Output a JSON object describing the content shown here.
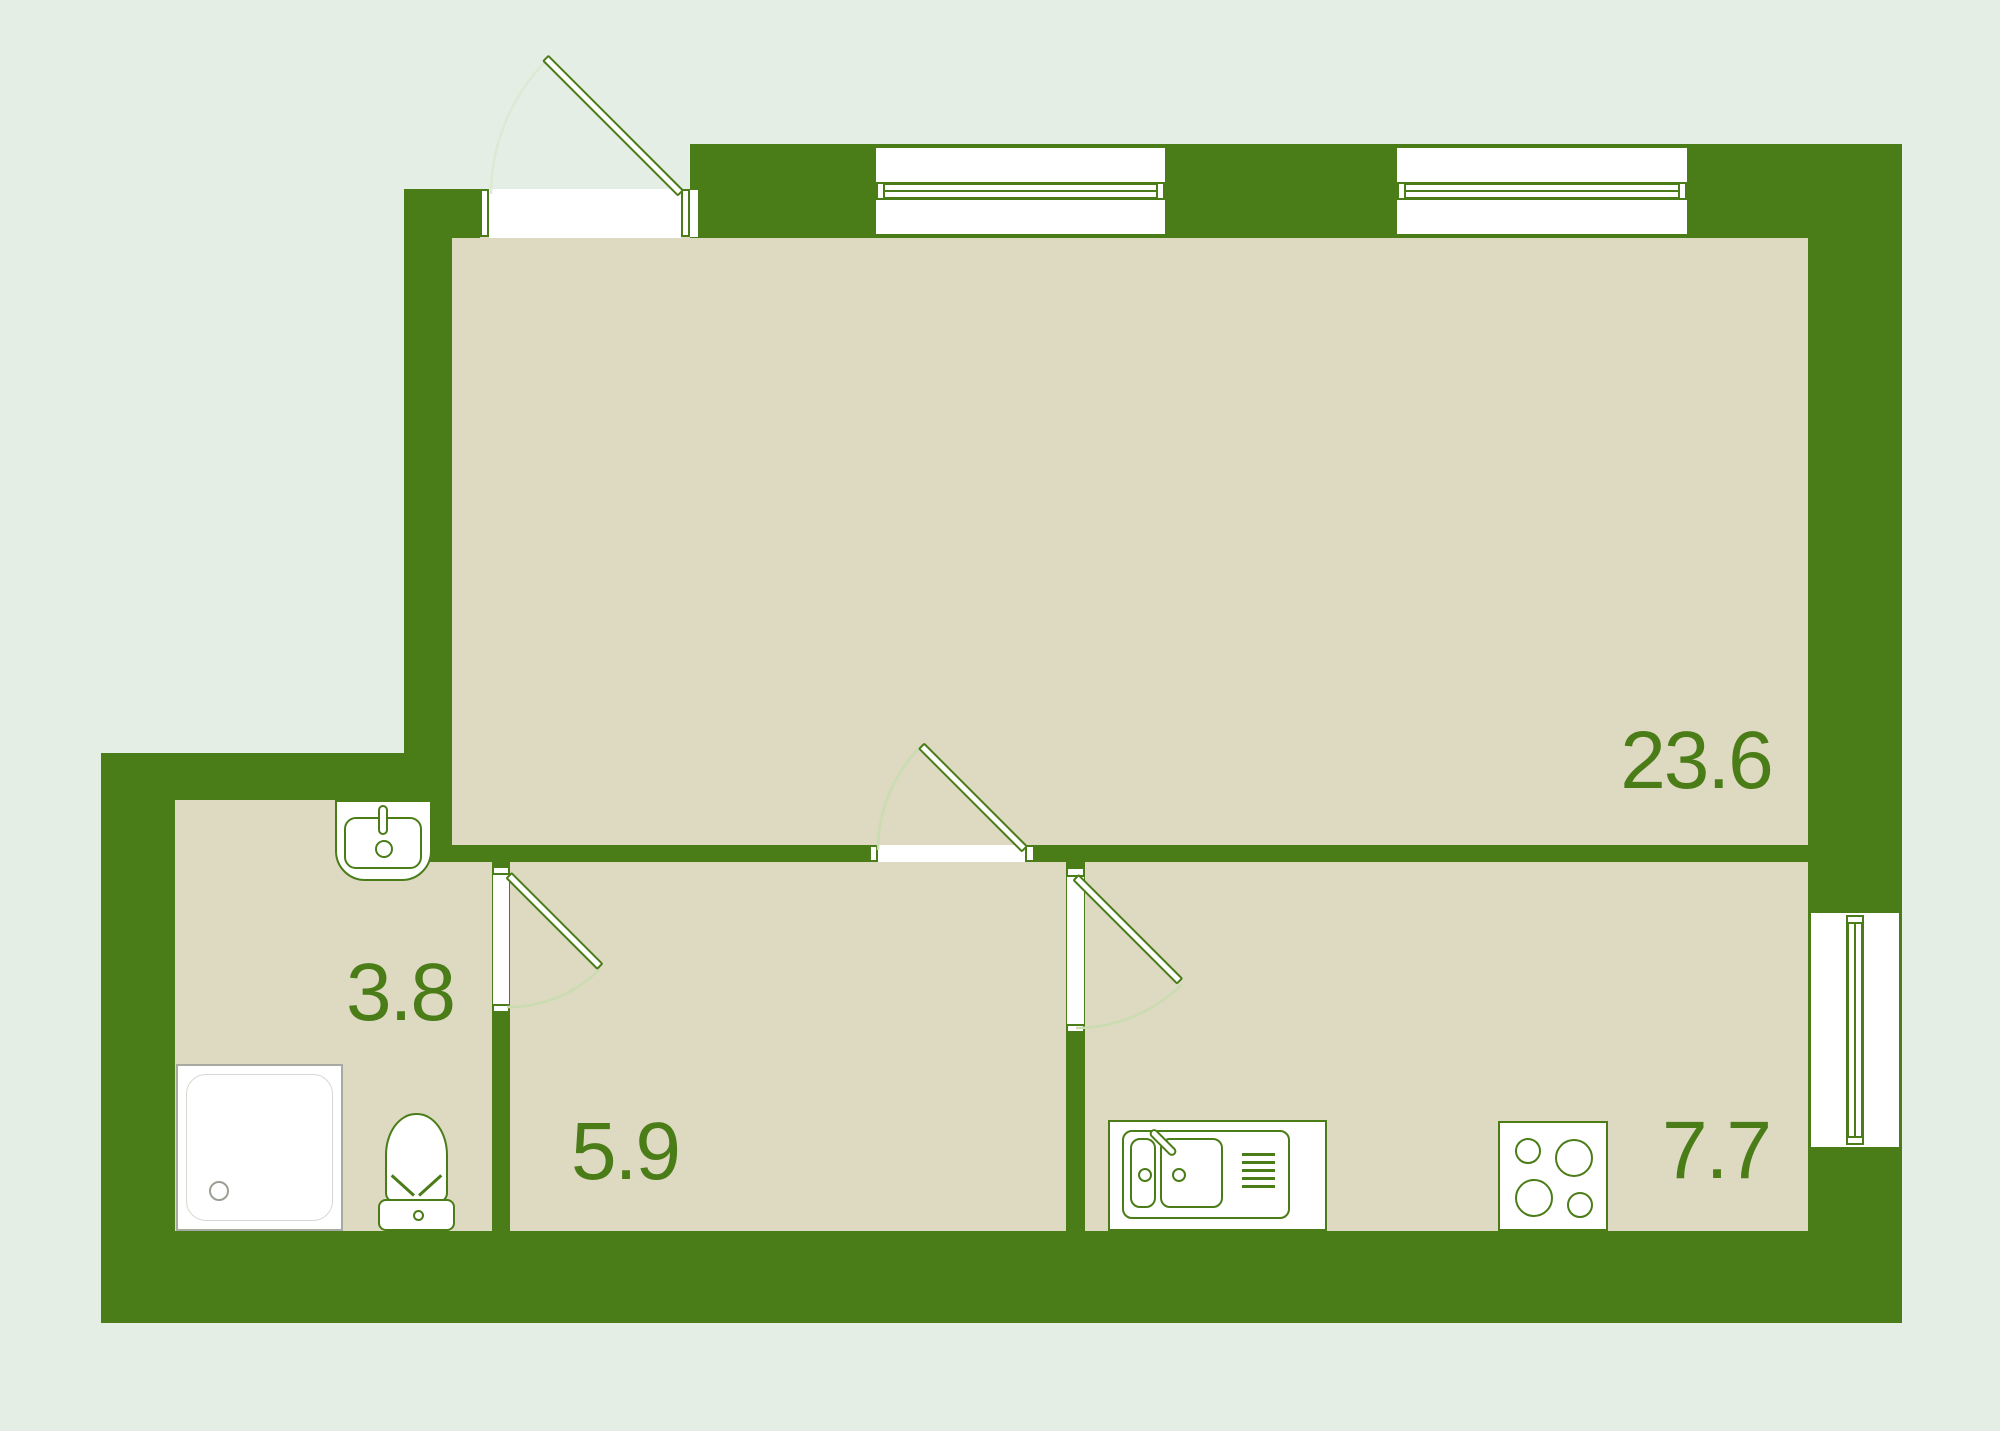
{
  "plan": {
    "type": "apartment-floor-plan",
    "rooms": [
      {
        "name": "living-room",
        "area_label": "23.6"
      },
      {
        "name": "bathroom",
        "area_label": "3.8"
      },
      {
        "name": "hallway",
        "area_label": "5.9"
      },
      {
        "name": "kitchen",
        "area_label": "7.7"
      }
    ],
    "fixtures": [
      "bathroom-sink",
      "shower-tray",
      "toilet",
      "kitchen-sink",
      "stove"
    ],
    "openings": {
      "windows": 3,
      "doors": 4
    },
    "colors": {
      "wall": "#4a7c17",
      "floor": "#ded9c1",
      "bg": "#e4eee5",
      "label": "#4a7c17",
      "arc": "#c9dcb2",
      "arc-light": "#dde9d4",
      "shower-line": "#a7aaa0"
    }
  }
}
